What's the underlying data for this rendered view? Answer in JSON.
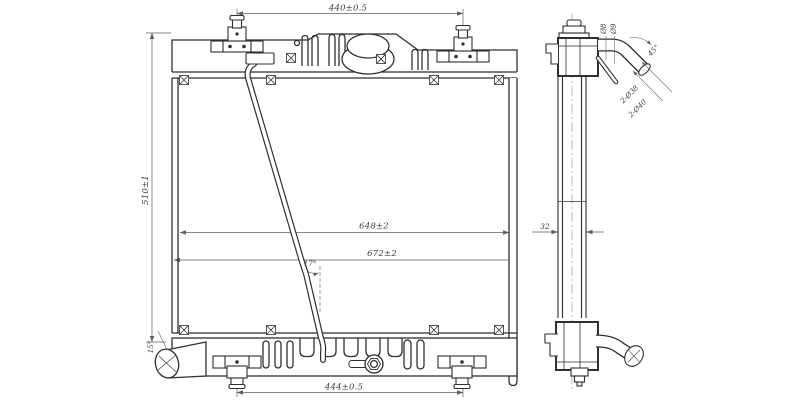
{
  "front_view": {
    "width_top": "440±0.5",
    "height_left": "510±1",
    "core_width_inner": "648±2",
    "core_width_outer": "672±2",
    "width_bottom": "444±0.5",
    "overflow_tube_angle": "17°",
    "outlet_pipe_angle": "15°"
  },
  "side_view": {
    "core_depth": "32",
    "inlet_pipe_angle": "45°",
    "overflow_nipple_inner": "Ø8",
    "overflow_nipple_outer": "Ø9",
    "pipes_inner_diameter": "2-Ø38",
    "pipes_outer_diameter": "2-Ø40"
  },
  "colors": {
    "background": "#ffffff",
    "line": "#2f2f2f",
    "dimension_line": "#5f5f5f",
    "text": "#3d3d3d"
  }
}
